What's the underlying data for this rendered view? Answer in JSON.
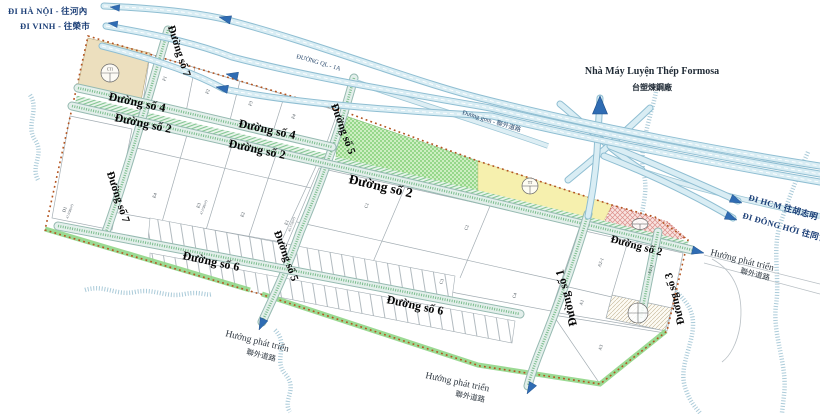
{
  "map": {
    "destinations": {
      "hanoi": "ĐI HÀ NỘI - 往河內",
      "vinh": "ĐI VINH - 往榮市",
      "hcm": "ĐI HCM 往胡志明",
      "dong_hoi": "ĐI ĐÔNG HỚI 往同會",
      "formosa_vi": "Nhà Máy Luyện Thép Formosa",
      "formosa_zh": "台塑煉鋼廠"
    },
    "development_label": {
      "vi": "Hướng phát triển",
      "zh": "聯外道路"
    },
    "roads": {
      "ql1a": "ĐƯỜNG QL - 1A",
      "gom": "Đường gom - 聯外道路",
      "so1": "Đường số 1",
      "so2": "Đường số 2",
      "so3": "Đường số 3",
      "so4": "Đường số 4",
      "so5": "Đường số 5",
      "so6": "Đường số 6",
      "so7": "Đường số 7"
    },
    "parcels": {
      "d1": {
        "id": "D1",
        "area": "47.658(m²)"
      },
      "e1": {
        "id": "E1",
        "area": "45.172(m²)"
      },
      "e2": {
        "id": "E2"
      },
      "e3": {
        "id": "E3",
        "area": "47.058(m²)"
      },
      "e4": {
        "id": "E4"
      },
      "f1": {
        "id": "F1"
      },
      "f2": {
        "id": "F2"
      },
      "f3": {
        "id": "F3"
      },
      "f4": {
        "id": "F4"
      },
      "c1": {
        "id": "C1"
      },
      "c2": {
        "id": "C2"
      },
      "c3": {
        "id": "C3"
      },
      "c4": {
        "id": "C4"
      },
      "a1": {
        "id": "A1"
      },
      "a21": {
        "id": "A2-1"
      },
      "a22": {
        "id": "A2-2"
      },
      "a3": {
        "id": "A3"
      }
    },
    "symbols": {
      "center_tan": "CT1",
      "center_yellow": "TT"
    },
    "colors": {
      "highway_fill": "#d9edf4",
      "highway_edge": "#8fbed2",
      "road_fill": "#e3efeb",
      "road_median_green": "#7bbd8d",
      "green_space": "#96d78b",
      "yellow_zone": "#f6f0ae",
      "red_zone_hatch": "#dc8f8a",
      "tan_zone": "#ecdfbe",
      "boundary": "#b3541f",
      "arrow_blue": "#2f6cb3",
      "label_navy": "#1c3f77"
    }
  }
}
